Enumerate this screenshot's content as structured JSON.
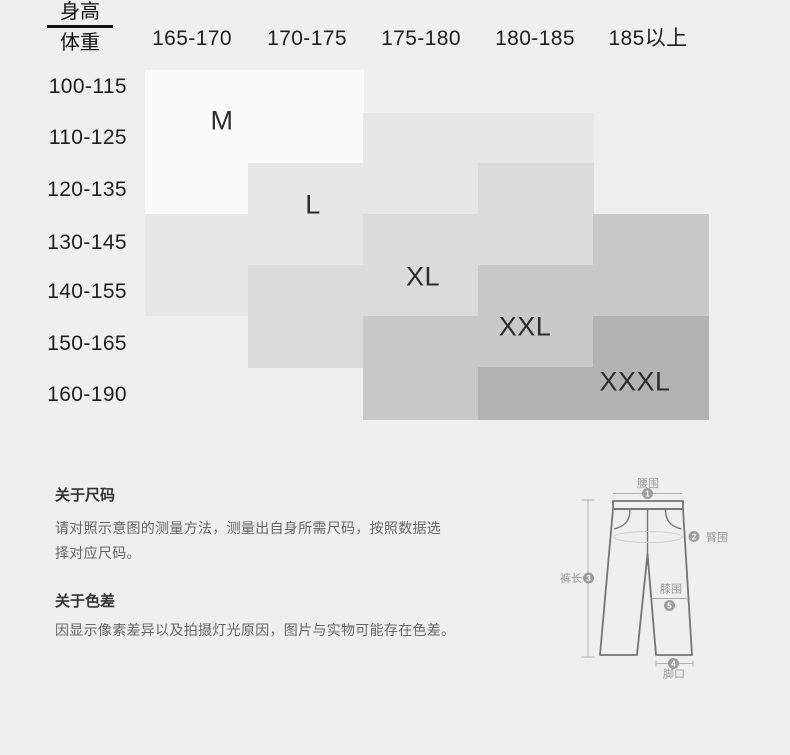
{
  "size_table": {
    "corner": {
      "top": "身高",
      "bottom": "体重"
    },
    "height_columns": [
      "165-170",
      "170-175",
      "175-180",
      "180-185",
      "185以上"
    ],
    "weight_rows": [
      "100-115",
      "110-125",
      "120-135",
      "130-145",
      "140-155",
      "150-165",
      "160-190"
    ],
    "sizes": [
      {
        "name": "M",
        "color": "#fafafa",
        "spans": [
          {
            "col": 0,
            "from": 0,
            "to": 3
          },
          {
            "col": 1,
            "from": 0,
            "to": 2
          }
        ]
      },
      {
        "name": "L",
        "color": "#e7e7e7",
        "spans": [
          {
            "col": 0,
            "from": 3,
            "to": 5
          },
          {
            "col": 1,
            "from": 2,
            "to": 4
          },
          {
            "col": 2,
            "from": 1,
            "to": 3
          },
          {
            "col": 3,
            "from": 1,
            "to": 2
          }
        ]
      },
      {
        "name": "XL",
        "color": "#dbdbdb",
        "spans": [
          {
            "col": 1,
            "from": 4,
            "to": 6
          },
          {
            "col": 2,
            "from": 3,
            "to": 5
          },
          {
            "col": 3,
            "from": 2,
            "to": 4
          }
        ]
      },
      {
        "name": "XXL",
        "color": "#c9c9c9",
        "spans": [
          {
            "col": 2,
            "from": 5,
            "to": 7
          },
          {
            "col": 3,
            "from": 4,
            "to": 6
          },
          {
            "col": 4,
            "from": 3,
            "to": 5
          }
        ]
      },
      {
        "name": "XXXL",
        "color": "#b3b3b3",
        "spans": [
          {
            "col": 3,
            "from": 6,
            "to": 7
          },
          {
            "col": 4,
            "from": 5,
            "to": 7
          }
        ]
      }
    ]
  },
  "chart_data": {
    "type": "heatmap",
    "title": "身高/体重 尺码表",
    "x_label": "身高",
    "y_label": "体重",
    "x_categories": [
      "165-170",
      "170-175",
      "175-180",
      "180-185",
      "185以上"
    ],
    "y_categories": [
      "100-115",
      "110-125",
      "120-135",
      "130-145",
      "140-155",
      "150-165",
      "160-190"
    ],
    "cells": [
      [
        "M",
        "M",
        null,
        null,
        null
      ],
      [
        "M",
        "M",
        "L",
        "L",
        null
      ],
      [
        "M",
        "L",
        "L",
        "XL",
        null
      ],
      [
        "L",
        "L",
        "XL",
        "XL",
        "XXL"
      ],
      [
        "L",
        "XL",
        "XL",
        "XXL",
        "XXL"
      ],
      [
        null,
        "XL",
        "XXL",
        "XXL",
        "XXXL"
      ],
      [
        null,
        null,
        "XXL",
        "XXXL",
        "XXXL"
      ]
    ],
    "legend": [
      "M",
      "L",
      "XL",
      "XXL",
      "XXXL"
    ],
    "palette": {
      "M": "#fafafa",
      "L": "#e7e7e7",
      "XL": "#dbdbdb",
      "XXL": "#c9c9c9",
      "XXXL": "#b3b3b3"
    },
    "background": "#efefef"
  },
  "notes": {
    "size_heading": "关于尺码",
    "size_lines": [
      "请对照示意图的测量方法，测量出自身所需尺码，按照数据选",
      "择对应尺码。"
    ],
    "color_heading": "关于色差",
    "color_line": "因显示像素差异以及拍摄灯光原因，图片与实物可能存在色差。"
  },
  "diagram": {
    "waist_label": "腰围",
    "waist_num": "1",
    "hip_label": "臀围",
    "hip_num": "2",
    "length_label": "裤长",
    "length_num": "3",
    "hem_label": "脚口",
    "hem_num": "4",
    "knee_label": "膝围",
    "knee_num": "5"
  }
}
